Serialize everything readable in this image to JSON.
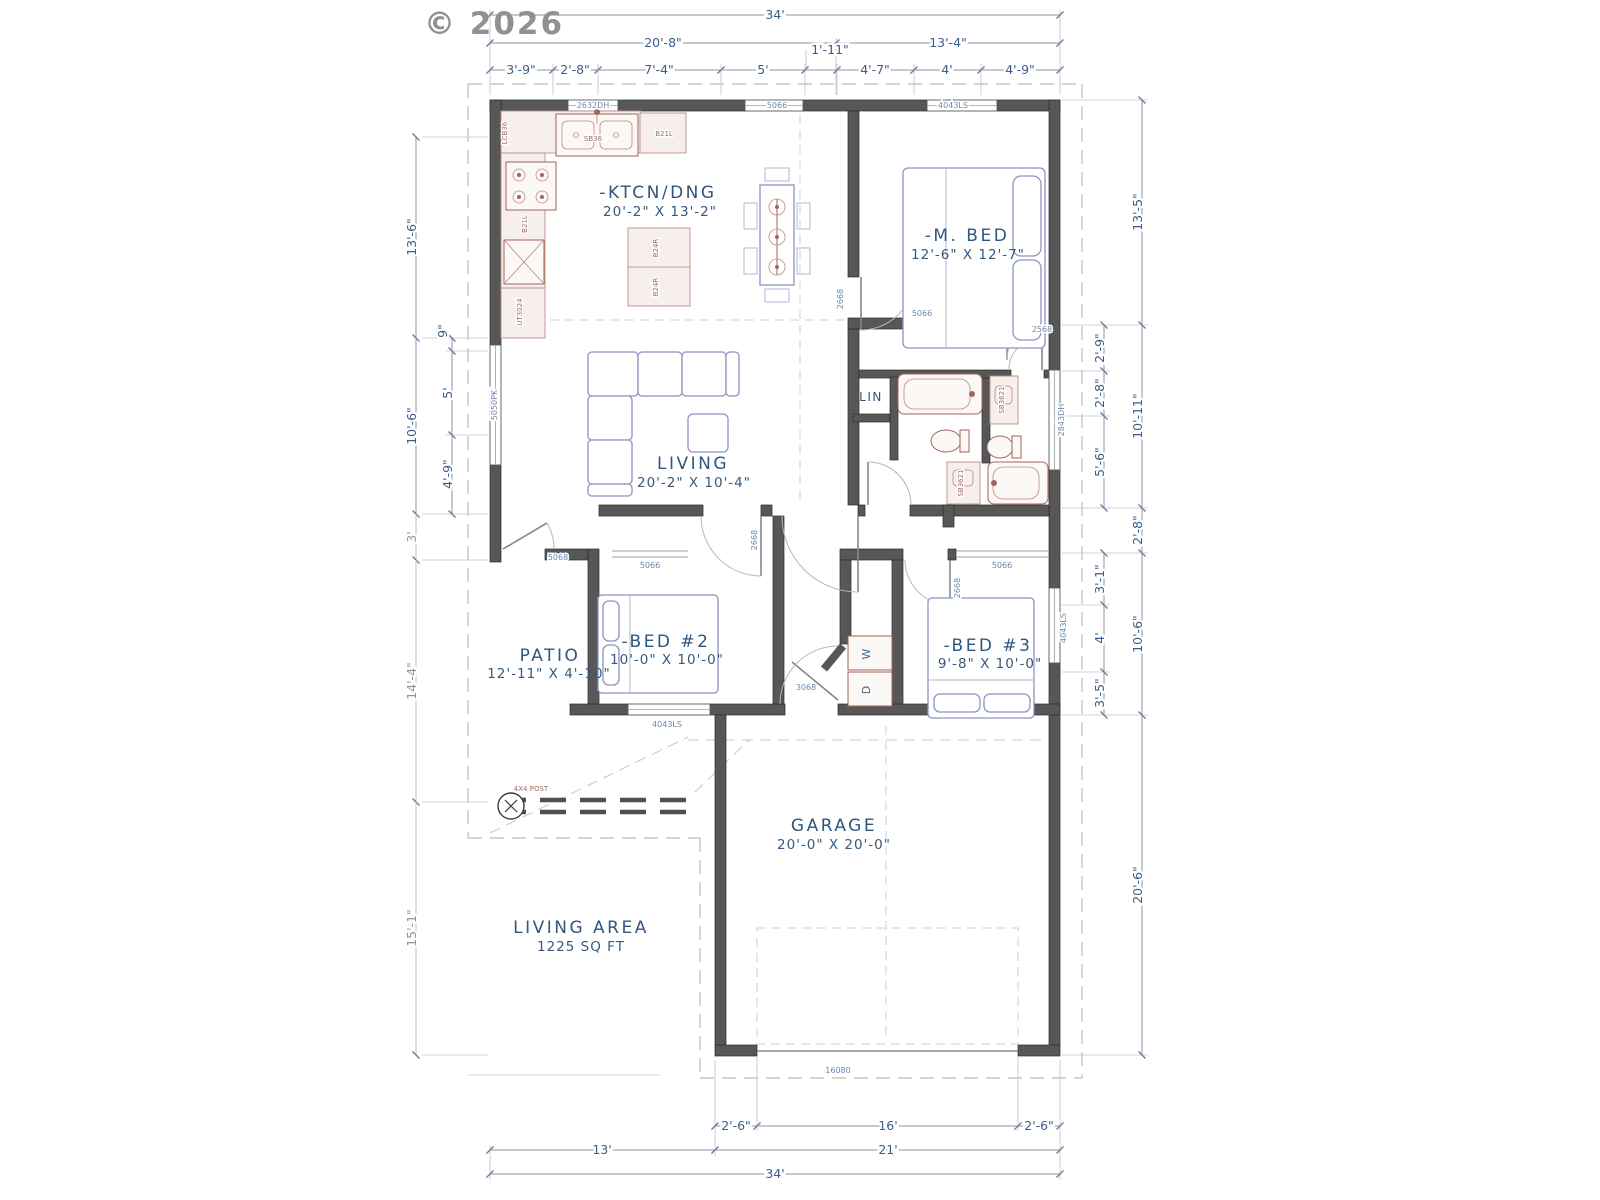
{
  "copyright": "© 2026",
  "rooms": {
    "kitchen": {
      "label": "-KTCN/DNG",
      "size": "20'-2\" X 13'-2\""
    },
    "master": {
      "label": "-M. BED",
      "size": "12'-6\" X 12'-7\""
    },
    "living": {
      "label": "LIVING",
      "size": "20'-2\" X 10'-4\""
    },
    "bed2": {
      "label": "-BED #2",
      "size": "10'-0\" X 10'-0\""
    },
    "bed3": {
      "label": "-BED #3",
      "size": "9'-8\" X 10'-0\""
    },
    "patio": {
      "label": "PATIO",
      "size": "12'-11\" X 4'-10\""
    },
    "garage": {
      "label": "GARAGE",
      "size": "20'-0\" X 20'-0\""
    },
    "living_area": {
      "label": "LIVING AREA",
      "size": "1225 SQ FT"
    },
    "linen": {
      "label": "LIN"
    }
  },
  "dims": {
    "top": {
      "total": "34'",
      "left": "20'-8\"",
      "right": "13'-4\"",
      "s1": "3'-9\"",
      "s2": "2'-8\"",
      "s3": "7'-4\"",
      "s4": "5'",
      "s5": "1'-11\"",
      "s6": "4'-7\"",
      "s7": "4'",
      "s8": "4'-9\""
    },
    "right": {
      "o1": "13'-5\"",
      "o2": "10'-11\"",
      "o3": "2'-8\"",
      "o4": "10'-6\"",
      "o5": "20'-6\"",
      "i1": "2'-9\"",
      "i2": "2'-8\"",
      "i3": "5'-6\"",
      "i4": "3'-1\"",
      "i5": "4'",
      "i6": "3'-5\""
    },
    "left": {
      "o1": "13'-6\"",
      "o2": "10'-6\"",
      "o3": "3'",
      "o4": "14'-4\"",
      "o5": "15'-1\"",
      "i1": "9\"",
      "i2": "5'",
      "i3": "4'-9\""
    },
    "bottom": {
      "g1": "2'-6\"",
      "g2": "16'",
      "g3": "2'-6\"",
      "b1": "13'",
      "b2": "21'",
      "total": "34'"
    }
  },
  "labels": {
    "win_kitchen": "2632DH",
    "win_dining": "5066",
    "win_master": "4043LS",
    "win_living": "5050PK",
    "win_bath": "2843DH",
    "win_bed2": "4043LS",
    "win_bed3": "4043LS",
    "closet_master": "5066",
    "closet_bed2": "5066",
    "closet_bed3": "5066",
    "door_master": "2668",
    "door_mbath": "2568",
    "door_bed2": "2668",
    "door_bed3": "2668",
    "door_patio": "5068",
    "door_entry": "3068",
    "garage_door": "16080",
    "sink": "SB36",
    "cab_b21l_a": "B21L",
    "cab_b21l_b": "B21L",
    "island_a": "B24R",
    "island_b": "B24R",
    "cab_tall": "LCB36",
    "cab_utility": "UT3024",
    "vanity_a": "SB3621",
    "vanity_b": "SB3621",
    "washer": "W",
    "dryer": "D",
    "post": "4X4 POST"
  }
}
